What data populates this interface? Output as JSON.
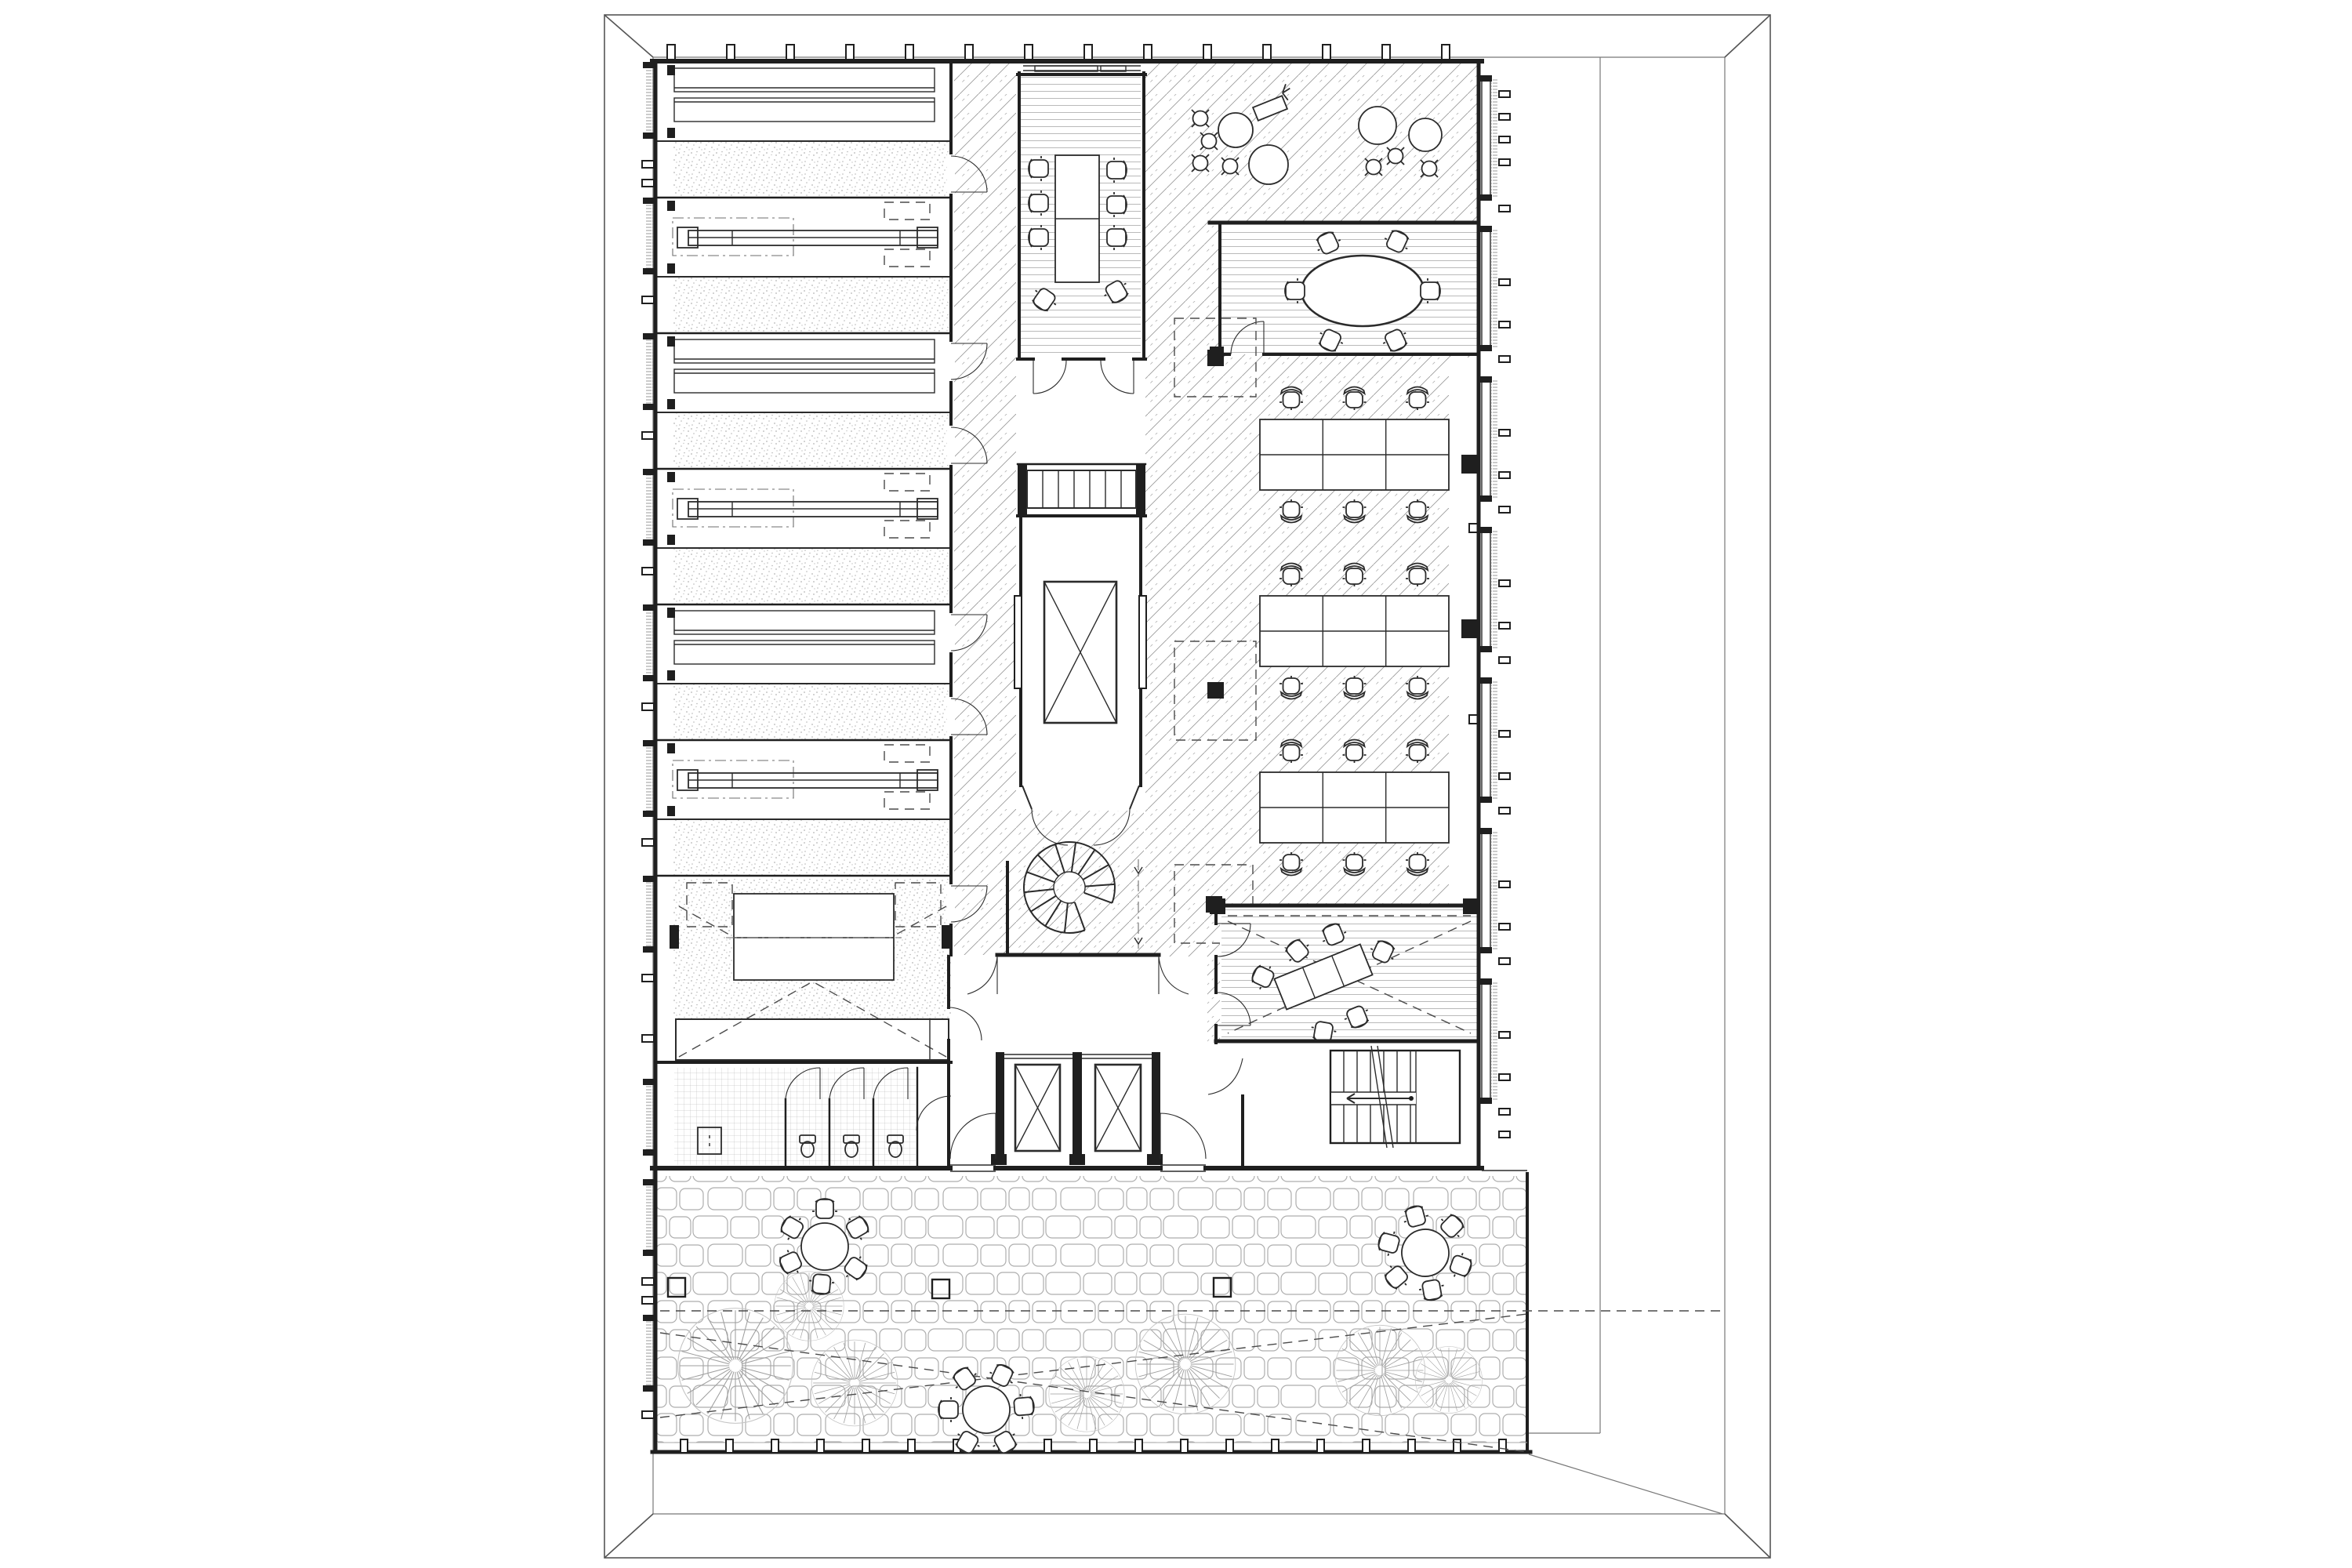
{
  "document": {
    "kind": "architectural floor plan",
    "style": "black and white CAD line drawing, plan view",
    "text_labels": [],
    "notes": "No text is rendered in the drawing; content is purely graphic."
  },
  "colors": {
    "ink": "#1f1f1f",
    "ink2": "#2b2b2b",
    "mid": "#6e6e6e",
    "lt": "#a9a9a9",
    "hatch": "#9b9b9b",
    "stipple": "#b5b5b5",
    "plank": "#9c9c9c",
    "stone": "#aeaeae",
    "dash": "#4a4a4a",
    "paper": "#ffffff"
  },
  "site": {
    "outer_boundary": "rectangle with mitred corner diagonals",
    "inner_boundary": "building parcel line",
    "courtyard": {
      "paving": "irregular flagstone pattern",
      "trees": 7,
      "round_tables": 3,
      "chairs_per_table": 6,
      "column_bases": 3,
      "edge_posts": "regular tick posts along south edge"
    }
  },
  "building": {
    "left_wing": {
      "rooms": 6,
      "room_contents": "long benches / paired worktables",
      "floor_bands": "stippled carpet strips",
      "doors_to_corridor": 6
    },
    "multipurpose_room": {
      "table": 1,
      "screen_projection": "dashed X",
      "platform": 1
    },
    "restroom": {
      "stalls": 3,
      "toilets": 3,
      "floor": "small tile grid"
    },
    "conference_room": {
      "table": 1,
      "chairs": 8,
      "floor": "wood planks"
    },
    "core": {
      "straight_stair_flights": 2,
      "elevators_single": 1,
      "elevators_pair": 2,
      "spiral_stair": 1
    },
    "open_office": {
      "desk_clusters": 3,
      "desks_per_cluster": 6,
      "task_chairs": 18,
      "floor": "diagonal hatch"
    },
    "lounge": {
      "round_tables": 4,
      "stools": 7,
      "chaise": 1
    },
    "meeting_room_north": {
      "oval_table": 1,
      "chairs": 6,
      "floor": "wood planks"
    },
    "meeting_room_south": {
      "rotated_table": 1,
      "chairs": 7,
      "screen_projection": "dashed X"
    },
    "facade": "window modules with brise-soleil fins on west, east and courtyard walls"
  },
  "icons": {
    "tree-icon": "radial-burst landscape tree symbol",
    "office-chair-icon": "task chair with curved back",
    "side-chair-icon": "square chair with back rail",
    "stool-icon": "round stool with four ticks",
    "elevator-icon": "shaft with X cab",
    "spiral-stair-icon": "C-shaped radial treads",
    "stair-arrow-icon": "direction-of-travel arrow",
    "toilet-icon": "wc fixture",
    "column-icon": "solid black pier"
  }
}
